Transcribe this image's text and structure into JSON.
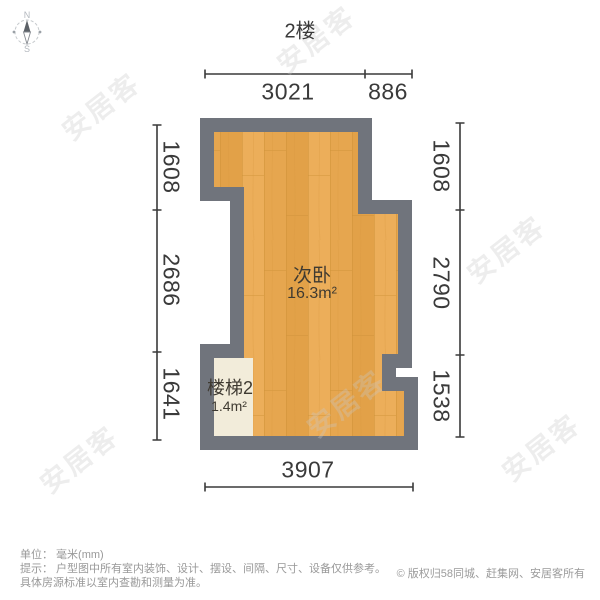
{
  "page": {
    "title": "2楼",
    "background": "#ffffff"
  },
  "compass": {
    "north_label": "N",
    "south_label": "S"
  },
  "floor_plan": {
    "room": {
      "name": "次卧",
      "area": "16.3m²"
    },
    "stairs": {
      "name": "楼梯2",
      "area": "1.4m²"
    },
    "colors": {
      "wall": "#70747c",
      "floor_base": "#e6a64f",
      "stairs_fill": "#f2ecda",
      "dimension_line": "#3a3a3a"
    }
  },
  "dimensions": {
    "unit": "mm",
    "top": [
      "3021",
      "886"
    ],
    "bottom": [
      "3907"
    ],
    "left": [
      "1608",
      "2686",
      "1641"
    ],
    "right": [
      "1608",
      "2790",
      "1538"
    ]
  },
  "footer": {
    "unit_line": "单位： 毫米(mm)",
    "tip_line1": "提示： 户型图中所有室内装饰、设计、摆设、间隔、尺寸、设备仅供参考。",
    "tip_line2": "具体房源标准以室内查勘和测量为准。",
    "copyright": "© 版权归58同城、赶集网、安居客所有"
  },
  "watermark": {
    "text": "安居客"
  }
}
